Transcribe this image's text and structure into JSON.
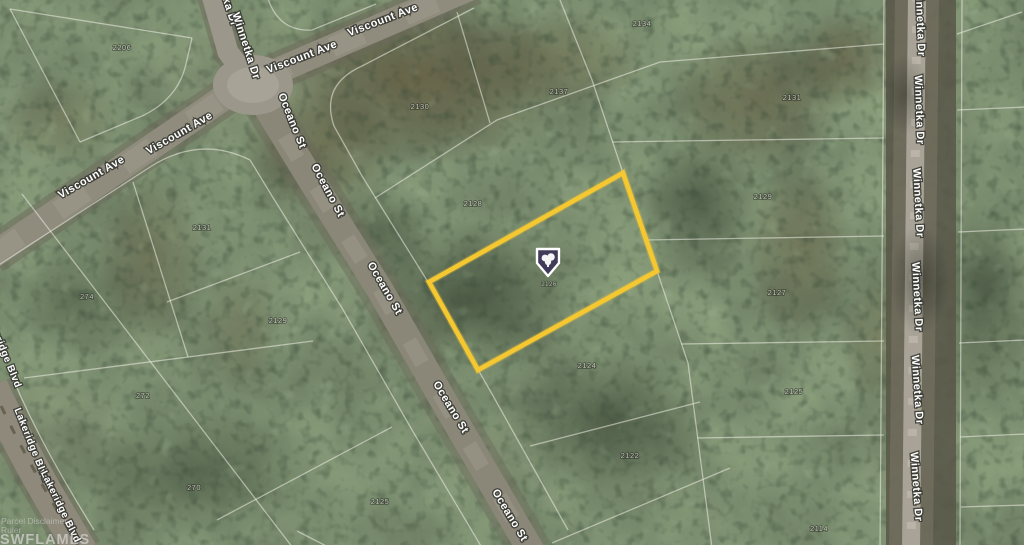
{
  "image": {
    "kind": "aerial-parcel-map-photo",
    "description": "Satellite view of wooded vacant subdivision lots; one listing parcel outlined in yellow with a location marker"
  },
  "roads": {
    "viscount_ave": {
      "label": "Viscount Ave"
    },
    "winnetka_dr": {
      "label": "Winnetka Dr"
    },
    "oceano_st": {
      "label": "Oceano St"
    },
    "lakeridge_blvd": {
      "label": "Lakeridge Blvd"
    }
  },
  "highlighted_parcel": {
    "outline_color": "#F5C832",
    "parcel_number": "2126"
  },
  "marker": {
    "icon": "shield-tree-marker",
    "fill_color": "#403B58"
  },
  "parcel_labels": [
    {
      "label": "2206"
    },
    {
      "label": "2130"
    },
    {
      "label": "2137"
    },
    {
      "label": "2134"
    },
    {
      "label": "2131"
    },
    {
      "label": "2129"
    },
    {
      "label": "2127"
    },
    {
      "label": "2125"
    },
    {
      "label": "2114"
    },
    {
      "label": "2128"
    },
    {
      "label": "2124"
    },
    {
      "label": "2122"
    },
    {
      "label": "2131"
    },
    {
      "label": "274"
    },
    {
      "label": "2129"
    },
    {
      "label": "272"
    },
    {
      "label": "270"
    },
    {
      "label": "2125"
    },
    {
      "label": "2126"
    }
  ],
  "watermark": {
    "line1": "Parcel Disclaimer",
    "line2": "Ruler",
    "line3": "SWFLAMLS"
  }
}
